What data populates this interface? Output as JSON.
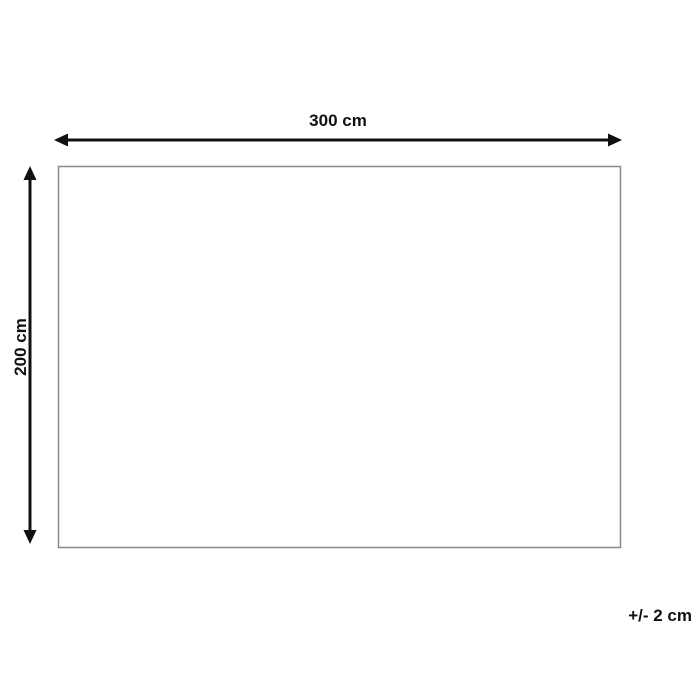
{
  "diagram": {
    "title": "product-dimensions-diagram",
    "width_label": "300 cm",
    "height_label": "200 cm",
    "tolerance_label": "+/- 2 cm",
    "colors": {
      "background": "#ffffff",
      "arrow": "#111111",
      "text": "#111111",
      "outline": "#8a8a8a"
    }
  }
}
